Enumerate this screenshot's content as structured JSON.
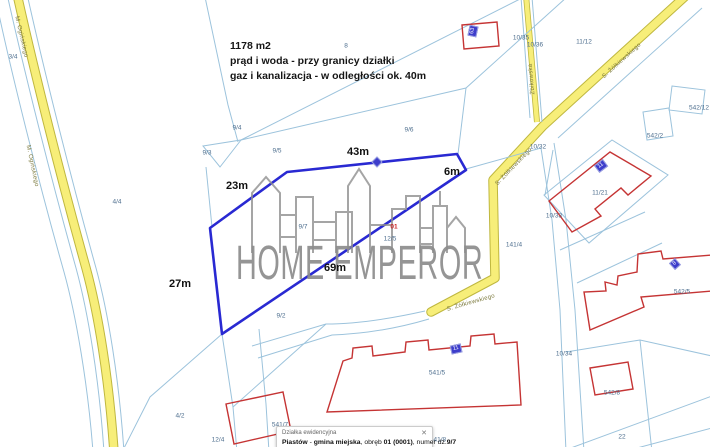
{
  "map": {
    "note_lines": [
      "1178 m2",
      "prąd i woda - przy granicy działki",
      "gaz i kanalizacja - w odległości ok. 40m"
    ],
    "watermark_text": "HOME EMPEROR",
    "colors": {
      "parcel_line": "#9cc3dc",
      "road_fill": "#f7ee79",
      "road_edge": "#bfb73f",
      "highlight_outline": "#2929d2",
      "building_outline": "#c53434",
      "badge_fill": "#3d3dcb",
      "watermark": "#8d8d8d"
    },
    "labels": [
      {
        "name": "measure-23m",
        "text": "23m",
        "x": 237,
        "y": 186,
        "cls": "measure"
      },
      {
        "name": "measure-43m",
        "text": "43m",
        "x": 358,
        "y": 152,
        "cls": "measure"
      },
      {
        "name": "measure-6m",
        "text": "6m",
        "x": 452,
        "y": 172,
        "cls": "measure"
      },
      {
        "name": "measure-69m",
        "text": "69m",
        "x": 335,
        "y": 268,
        "cls": "measure"
      },
      {
        "name": "measure-27m",
        "text": "27m",
        "x": 180,
        "y": 284,
        "cls": "measure"
      },
      {
        "name": "parcel-3-4",
        "text": "3/4",
        "x": 13,
        "y": 57,
        "cls": "parcel"
      },
      {
        "name": "parcel-4-4",
        "text": "4/4",
        "x": 117,
        "y": 202,
        "cls": "parcel"
      },
      {
        "name": "parcel-8",
        "text": "8",
        "x": 346,
        "y": 46,
        "cls": "parcel"
      },
      {
        "name": "parcel-9-4",
        "text": "9/4",
        "x": 237,
        "y": 128,
        "cls": "parcel"
      },
      {
        "name": "parcel-9-3",
        "text": "9/3",
        "x": 207,
        "y": 153,
        "cls": "parcel"
      },
      {
        "name": "parcel-9-5",
        "text": "9/5",
        "x": 277,
        "y": 151,
        "cls": "parcel"
      },
      {
        "name": "parcel-9-6",
        "text": "9/6",
        "x": 409,
        "y": 130,
        "cls": "parcel"
      },
      {
        "name": "parcel-9-7",
        "text": "9/7",
        "x": 303,
        "y": 227,
        "cls": "parcel"
      },
      {
        "name": "parcel-9-2",
        "text": "9/2",
        "x": 281,
        "y": 316,
        "cls": "parcel"
      },
      {
        "name": "parcel-4-2",
        "text": "4/2",
        "x": 180,
        "y": 416,
        "cls": "parcel"
      },
      {
        "name": "parcel-12-4",
        "text": "12/4",
        "x": 218,
        "y": 440,
        "cls": "parcel"
      },
      {
        "name": "parcel-12-5",
        "text": "12/5",
        "x": 390,
        "y": 239,
        "cls": "parcel"
      },
      {
        "name": "label-01",
        "text": "01",
        "x": 394,
        "y": 227,
        "cls": "red"
      },
      {
        "name": "parcel-11-12",
        "text": "11/12",
        "x": 584,
        "y": 42,
        "cls": "parcel"
      },
      {
        "name": "parcel-10-35",
        "text": "10/35",
        "x": 521,
        "y": 38,
        "cls": "parcel"
      },
      {
        "name": "parcel-10-36",
        "text": "10/36",
        "x": 535,
        "y": 45,
        "cls": "parcel"
      },
      {
        "name": "parcel-10-32",
        "text": "10/32",
        "x": 538,
        "y": 147,
        "cls": "parcel"
      },
      {
        "name": "parcel-10-33",
        "text": "10/33",
        "x": 554,
        "y": 216,
        "cls": "parcel"
      },
      {
        "name": "parcel-10-34",
        "text": "10/34",
        "x": 564,
        "y": 354,
        "cls": "parcel"
      },
      {
        "name": "parcel-11-21",
        "text": "11/21",
        "x": 600,
        "y": 193,
        "cls": "parcel"
      },
      {
        "name": "parcel-542-12",
        "text": "542/12",
        "x": 699,
        "y": 108,
        "cls": "parcel"
      },
      {
        "name": "parcel-542-2",
        "text": "542/2",
        "x": 655,
        "y": 136,
        "cls": "parcel"
      },
      {
        "name": "parcel-542-5",
        "text": "542/5",
        "x": 682,
        "y": 292,
        "cls": "parcel"
      },
      {
        "name": "parcel-542-8",
        "text": "542/8",
        "x": 612,
        "y": 393,
        "cls": "parcel"
      },
      {
        "name": "parcel-141-4",
        "text": "141/4",
        "x": 514,
        "y": 245,
        "cls": "parcel"
      },
      {
        "name": "parcel-541-5",
        "text": "541/5",
        "x": 437,
        "y": 373,
        "cls": "parcel"
      },
      {
        "name": "parcel-541-7",
        "text": "541/7",
        "x": 280,
        "y": 425,
        "cls": "parcel"
      },
      {
        "name": "parcel-541-8",
        "text": "541/8",
        "x": 438,
        "y": 440,
        "cls": "parcel"
      },
      {
        "name": "parcel-22",
        "text": "22",
        "x": 622,
        "y": 437,
        "cls": "parcel"
      },
      {
        "name": "road-label-oginskiego-1",
        "text": "M. Ogińskiego",
        "x": 21,
        "y": 37,
        "cls": "road",
        "rot": 77
      },
      {
        "name": "road-label-oginskiego-2",
        "text": "M. Ogińskiego",
        "x": 32,
        "y": 166,
        "cls": "road",
        "rot": 78
      },
      {
        "name": "road-label-zbikowska",
        "text": "Żbikowska",
        "x": 532,
        "y": 79,
        "cls": "road",
        "rot": -95
      },
      {
        "name": "road-label-zolkiewskiego-1",
        "text": "S. Żółkiewskiego",
        "x": 622,
        "y": 61,
        "cls": "road",
        "rot": -42
      },
      {
        "name": "road-label-zolkiewskiego-2",
        "text": "S. Żółkiewskiego",
        "x": 514,
        "y": 167,
        "cls": "road",
        "rot": -46
      },
      {
        "name": "road-label-zolkiewskiego-3",
        "text": "S. Żółkiewskiego",
        "x": 471,
        "y": 303,
        "cls": "road",
        "rot": -16
      }
    ],
    "badges": [
      {
        "name": "address-badge-63",
        "text": "63",
        "x": 473,
        "y": 31,
        "rot": -78,
        "shape": "rect"
      },
      {
        "name": "subject-parcel-marker",
        "text": "",
        "x": 377,
        "y": 162,
        "rot": 45,
        "shape": "diamond"
      },
      {
        "name": "address-badge-11",
        "text": "11",
        "x": 601,
        "y": 166,
        "rot": -37,
        "shape": "rect"
      },
      {
        "name": "address-badge-8",
        "text": "8",
        "x": 675,
        "y": 264,
        "rot": -42,
        "shape": "rect"
      },
      {
        "name": "address-badge-11b",
        "text": "11",
        "x": 456,
        "y": 349,
        "rot": -12,
        "shape": "rect"
      }
    ],
    "info_box": {
      "title": "Działka ewidencyjna",
      "close_icon": "✕",
      "description_parts": [
        {
          "text": "Piastów",
          "bold": true
        },
        {
          "text": " - ",
          "bold": false
        },
        {
          "text": "gmina miejska",
          "bold": true
        },
        {
          "text": ", obręb ",
          "bold": false
        },
        {
          "text": "01 (0001)",
          "bold": true
        },
        {
          "text": ", numer dz.",
          "bold": false
        },
        {
          "text": "9/7",
          "bold": true
        }
      ]
    }
  }
}
